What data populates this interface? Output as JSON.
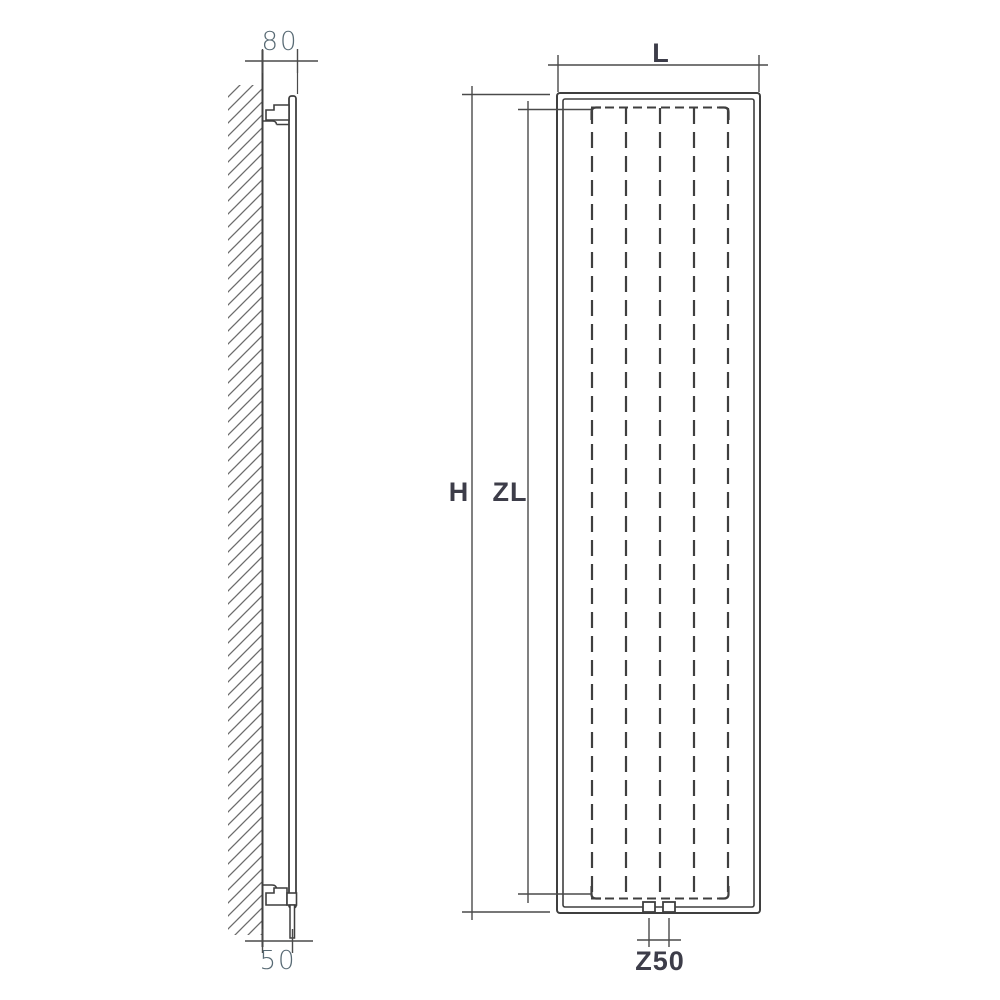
{
  "drawing": {
    "title": "Vertical radiator dimension drawing (side view and front view)",
    "side_view": {
      "wall_to_front_depth_label": "80",
      "wall_to_connection_label": "50"
    },
    "front_view": {
      "width_label": "L",
      "height_label": "H",
      "axial_length_label": "ZL",
      "connection_spacing_label": "Z50"
    }
  },
  "colors": {
    "line": "#3f3f3f",
    "dimline": "#4a4a4a",
    "hatch": "#6b6b6b",
    "label_light": "#586a74",
    "label_dark": "#3d3d49",
    "background": "#ffffff"
  }
}
